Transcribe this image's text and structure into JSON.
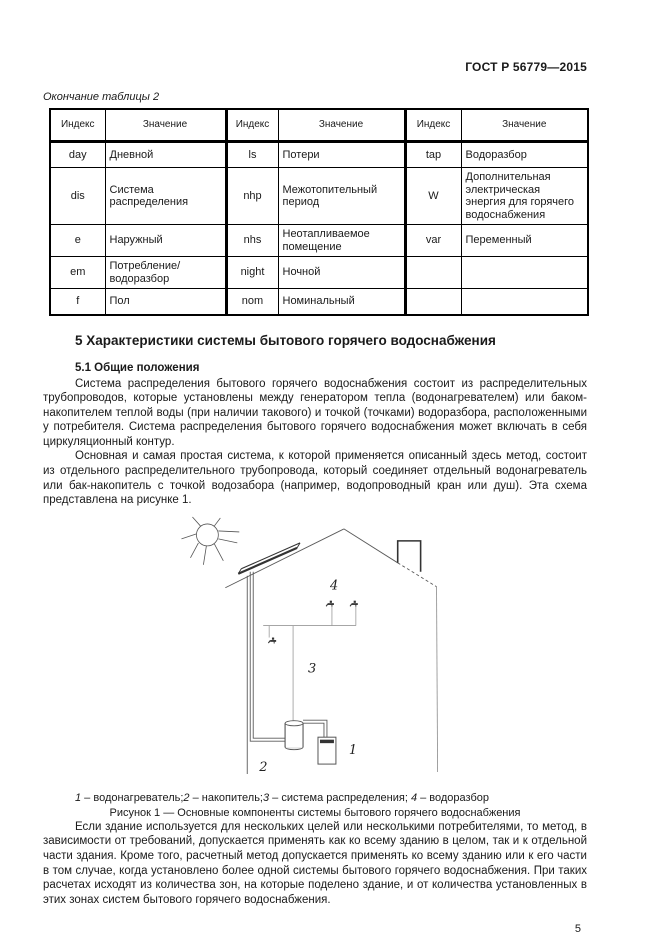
{
  "header": {
    "doc_code": "ГОСТ Р 56779—2015"
  },
  "table": {
    "continuation_label": "Окончание таблицы 2",
    "columns": [
      "Индекс",
      "Значение",
      "Индекс",
      "Значение",
      "Индекс",
      "Значение"
    ],
    "rows": [
      [
        "day",
        "Дневной",
        "ls",
        "Потери",
        "tap",
        "Водоразбор"
      ],
      [
        "dis",
        "Система распределения",
        "nhp",
        "Межотопительный период",
        "W",
        "Дополнительная электрическая энергия для горячего водоснабжения"
      ],
      [
        "e",
        "Наружный",
        "nhs",
        "Неотапливаемое помещение",
        "var",
        "Переменный"
      ],
      [
        "em",
        "Потребление/ водоразбор",
        "night",
        "Ночной",
        "",
        ""
      ],
      [
        "f",
        "Пол",
        "nom",
        "Номинальный",
        "",
        ""
      ]
    ]
  },
  "section": {
    "heading": "5 Характеристики системы бытового горячего водоснабжения",
    "subheading": "5.1 Общие положения",
    "paragraph1": "Система распределения бытового горячего водоснабжения состоит из распределительных трубопроводов, которые установлены между генератором тепла (водонагревателем) или баком-накопителем теплой воды (при наличии такового) и точкой (точками) водоразбора, расположенными у потребителя. Система распределения бытового горячего водоснабжения может включать в себя циркуляционный контур.",
    "paragraph2": "Основная и самая простая система, к которой применяется описанный здесь метод, состоит из отдельного распределительного трубопровода, который соединяет отдельный водонагреватель или бак-накопитель с точкой водозабора (например, водопроводный кран или душ). Эта схема представлена на рисунке 1.",
    "closing_paragraph": "Если здание используется для нескольких целей или несколькими потребителями, то метод, в зависимости от требований, допускается применять как ко всему зданию в целом, так и к отдельной части здания. Кроме того, расчетный метод допускается применять ко всему зданию или к его части в том случае, когда установлено более одной системы бытового горячего водоснабжения. При таких расчетах исходят из количества зон, на которые поделено здание, и от количества установленных в этих зонах систем бытового горячего водоснабжения."
  },
  "figure": {
    "labels": {
      "heater": "1",
      "tank": "2",
      "distribution": "3",
      "tap": "4"
    },
    "legend": [
      {
        "num": "1",
        "text": " – водонагреватель;"
      },
      {
        "num": "2",
        "text": " – накопитель;"
      },
      {
        "num": "3",
        "text": " – система распределения; "
      },
      {
        "num": "4",
        "text": " – водоразбор"
      }
    ],
    "caption": "Рисунок 1 — Основные компоненты системы бытового горячего водоснабжения"
  },
  "page_number": "5"
}
